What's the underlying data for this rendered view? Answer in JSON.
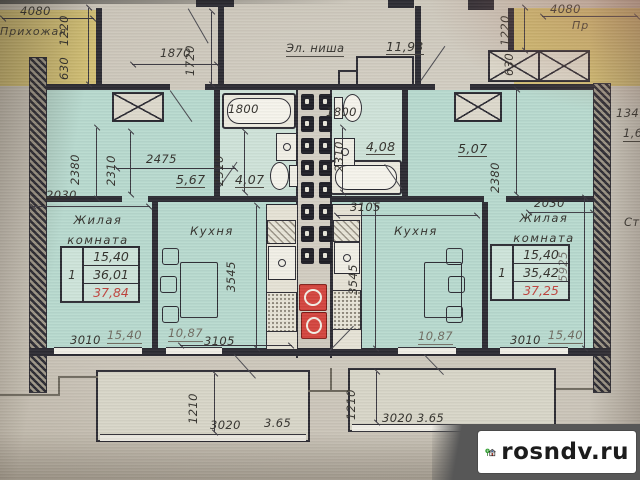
{
  "palette": {
    "wall": "#2c2b33",
    "unit_fill": "#b8dacf",
    "hall_fill": "#d2bf74",
    "stove_red": "#d4453e",
    "red_text": "#c0443e"
  },
  "watermark": {
    "site": "rosndv.ru"
  },
  "top": {
    "left_hall": {
      "name": "Прихожая",
      "dim_top": "4080",
      "dim_side": "1220",
      "dim_side2": "630"
    },
    "corridor": {
      "dim_w": "1870",
      "dim_h": "1720",
      "niche_label": "Эл. ниша",
      "niche_area": "11,93"
    },
    "right_hall": {
      "name": "Пр",
      "dim_top": "4080",
      "dim_side": "1220",
      "dim_side2": "630"
    },
    "right_edge": {
      "dim": "134",
      "area": "1,6",
      "text": "Ст"
    }
  },
  "left_unit": {
    "hall": {
      "dim_w": "2475",
      "area": "5,67",
      "dim_h1": "2380",
      "dim_h2": "2310",
      "dim_top_room": "2030"
    },
    "bath": {
      "area": "4,07",
      "tub_dim": "1800",
      "dim_h": "2310"
    },
    "living": {
      "name": "Жилая комната",
      "table_no": "1",
      "areas": [
        "15,40",
        "36,01",
        "37,84"
      ],
      "dim_bottom": "3010",
      "dim_bottom_area": "15,40"
    },
    "kitchen": {
      "name": "Кухня",
      "dim_h": "3545",
      "area": "10,87",
      "dim_w": "3105"
    },
    "balcony": {
      "dim_d": "1210",
      "dim_w": "3020",
      "area": "3.65"
    }
  },
  "right_unit": {
    "bath": {
      "area": "4,08",
      "tub_dim": "1800",
      "dim_h": "2310",
      "dim_w": "3105"
    },
    "hall": {
      "area": "5,07",
      "dim_h": "2380",
      "dim_top_room": "2030"
    },
    "living": {
      "name": "Жилая комната",
      "table_no": "1",
      "areas": [
        "15,40",
        "35,42",
        "37,25"
      ],
      "dim_h": "5925",
      "dim_bottom": "3010",
      "dim_bottom_area": "15,40"
    },
    "kitchen": {
      "name": "Кухня",
      "dim_h": "3545",
      "area": "10,87"
    },
    "balcony": {
      "dim_d": "1210",
      "dim_w_area": "3020 3.65"
    }
  }
}
